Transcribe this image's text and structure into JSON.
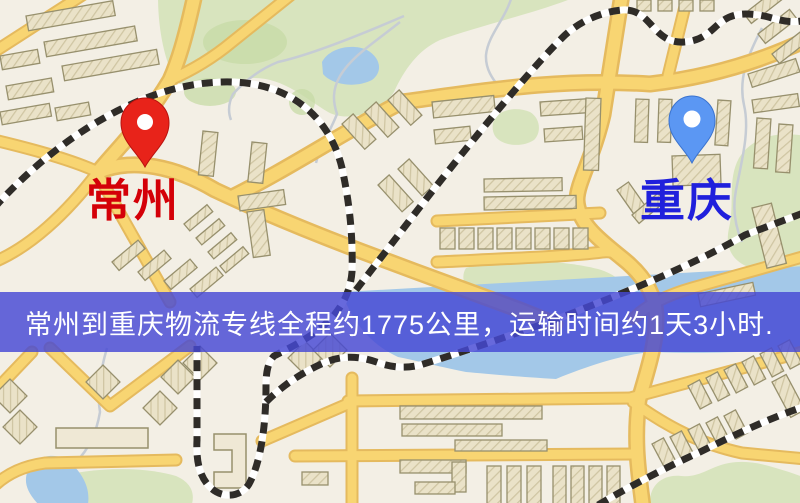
{
  "map": {
    "type": "road-map",
    "background_color": "#f3efe5",
    "origin": {
      "label": "常州",
      "label_color": "#d40008",
      "pin_color": "#e8231a",
      "pin_style": "red-marker"
    },
    "destination": {
      "label": "重庆",
      "label_color": "#2020dc",
      "pin_color": "#5b97f3",
      "pin_style": "blue-marker"
    },
    "legend_colors": {
      "road": "#f8d572",
      "road_casing": "#e5ba5e",
      "railway": "#2f2c28",
      "building": "#eae1c6",
      "building_outline": "#97906d",
      "park": "#d8e4be",
      "water": "#a3c8e8"
    }
  },
  "banner": {
    "text": "常州到重庆物流专线全程约1775公里，运输时间约1天3小时.",
    "background_color": "#4648d4",
    "text_color": "#ffffff",
    "route_distance_km": "1775",
    "transit_time": "1天3小时"
  }
}
